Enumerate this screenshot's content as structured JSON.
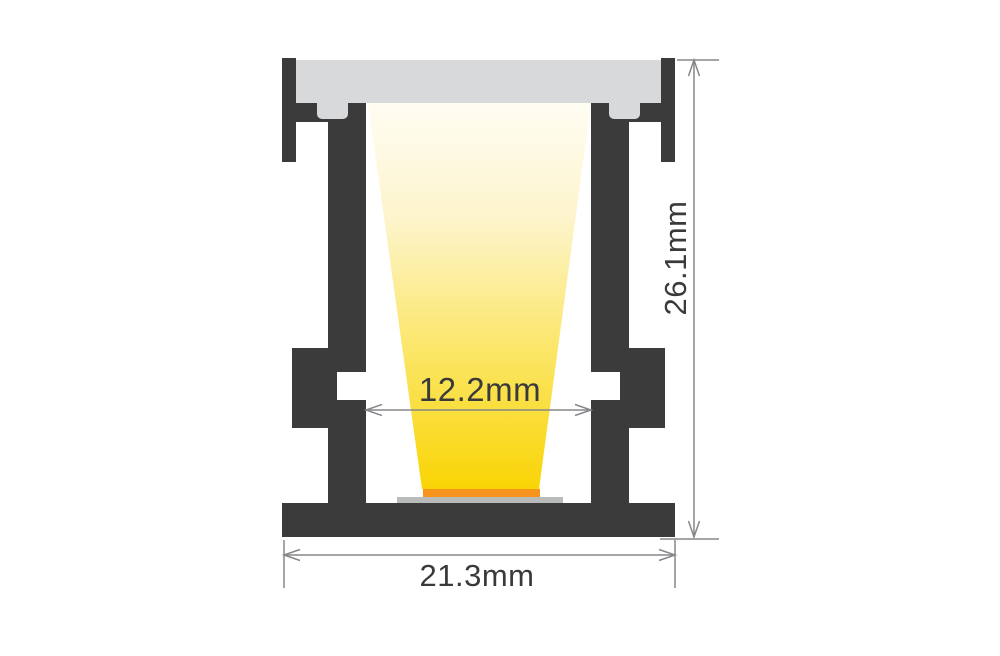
{
  "drawing": {
    "type": "led-profile-cross-section-dimension-drawing",
    "dimensions": {
      "inner_width": "12.2mm",
      "overall_width": "21.3mm",
      "overall_height": "26.1mm"
    }
  },
  "colors": {
    "background": "#ffffff",
    "profile": "#3b3b3c",
    "diffuser": "#d8d9da",
    "led_strip": "#f7941e",
    "led_base": "#b9bbba",
    "beam_top": "#fffdf3",
    "beam_upper": "#fdf4cc",
    "beam_mid": "#fbe76e",
    "beam_bottom": "#f9d405",
    "dimension_line": "#85878a",
    "dimension_text": "#3a3a3a"
  }
}
